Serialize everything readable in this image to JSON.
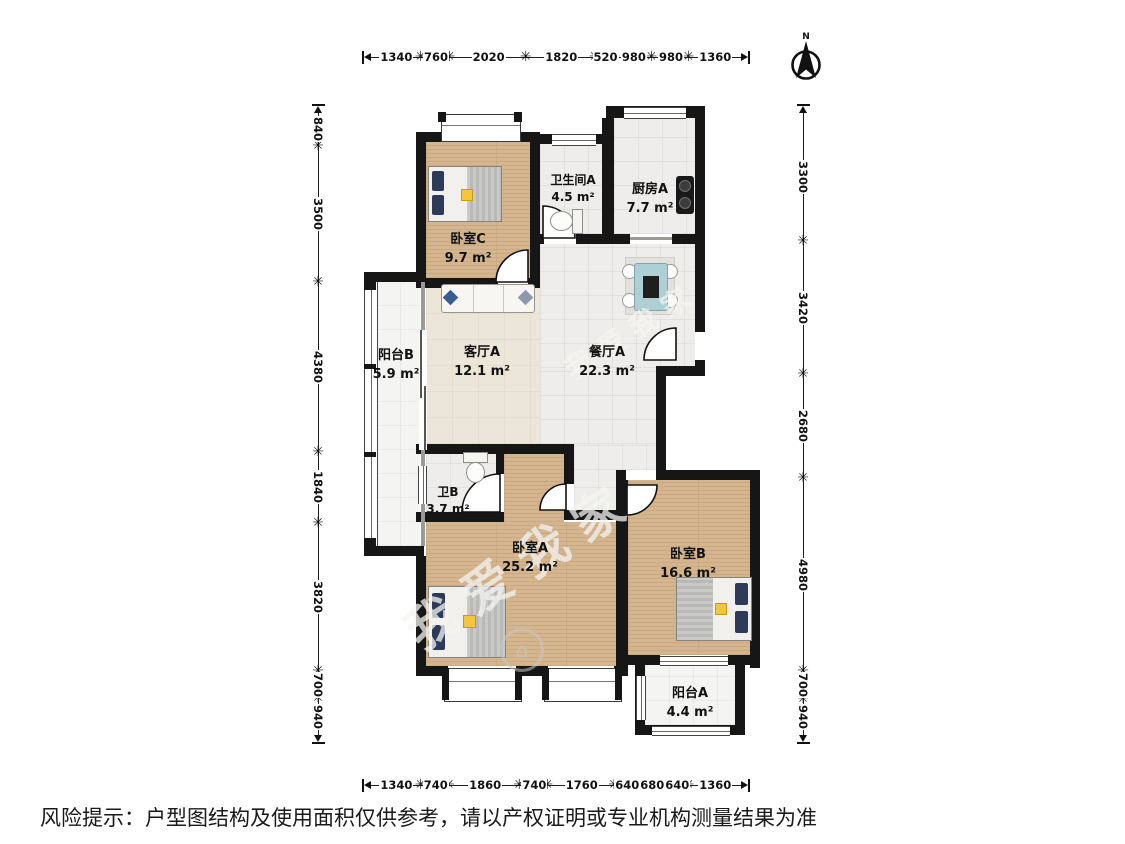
{
  "compass": {
    "label": "N"
  },
  "rooms": [
    {
      "name": "卧室C",
      "area": "9.7 m²"
    },
    {
      "name": "卫生间A",
      "area": "4.5 m²"
    },
    {
      "name": "厨房A",
      "area": "7.7 m²"
    },
    {
      "name": "阳台B",
      "area": "5.9 m²"
    },
    {
      "name": "客厅A",
      "area": "12.1 m²"
    },
    {
      "name": "餐厅A",
      "area": "22.3 m²"
    },
    {
      "name": "卫B",
      "area": "3.7 m²"
    },
    {
      "name": "卧室A",
      "area": "25.2 m²"
    },
    {
      "name": "卧室B",
      "area": "16.6 m²"
    },
    {
      "name": "阳台A",
      "area": "4.4 m²"
    }
  ],
  "dimensions": {
    "top": [
      "1340",
      "760",
      "2020",
      "1820",
      "520",
      "980",
      "980",
      "1360"
    ],
    "bottom": [
      "1340",
      "740",
      "1860",
      "740",
      "1760",
      "640",
      "680",
      "640",
      "1360"
    ],
    "left": [
      "840",
      "3500",
      "4380",
      "1840",
      "3820",
      "700",
      "940"
    ],
    "right": [
      "3300",
      "3420",
      "2680",
      "4980",
      "700",
      "940"
    ]
  },
  "watermark": {
    "text": "我爱我家",
    "logo_glyph": "⌂"
  },
  "disclaimer": "风险提示：户型图结构及使用面积仅供参考，请以产权证明或专业机构测量结果为准",
  "colors": {
    "wall": "#161616",
    "wood": "#d4b58e",
    "tile": "#eeedeb",
    "cream": "#ece6d8",
    "accent_pillow": "#2d3b58"
  }
}
